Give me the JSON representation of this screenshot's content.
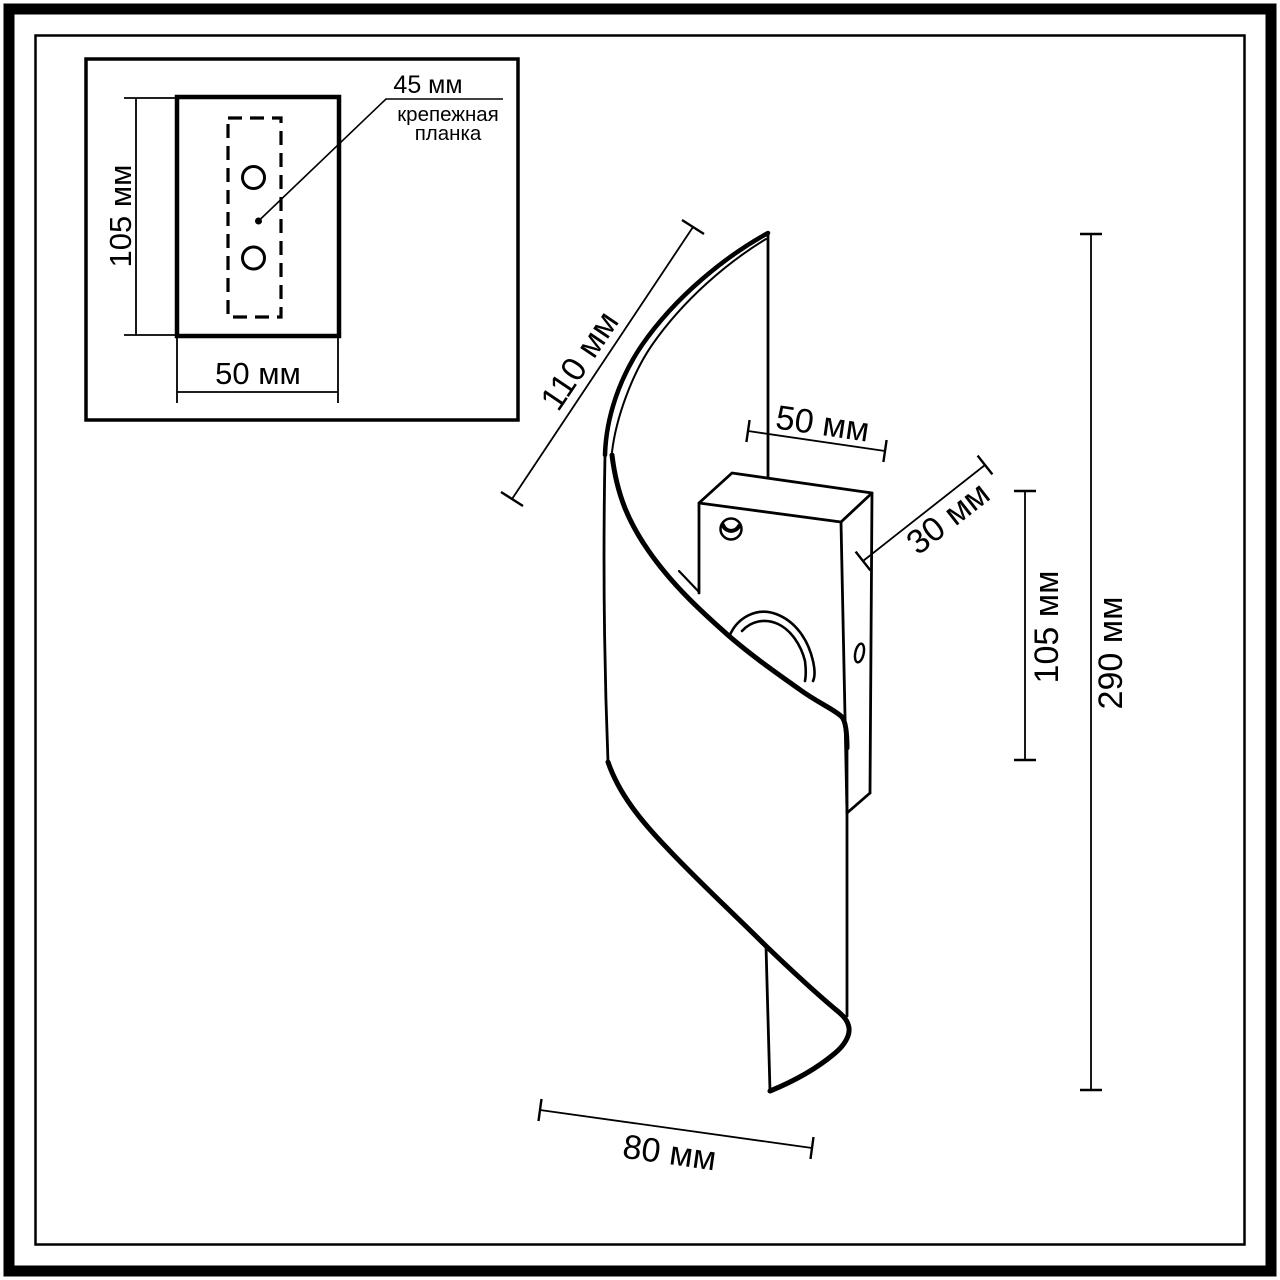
{
  "drawing": {
    "type": "dimensional line drawing",
    "subject": "spiral wall sconce with mounting plate"
  },
  "inset": {
    "plate_height": "105 мм",
    "plate_width": "50 мм",
    "hole_spacing": "45 мм",
    "callout_line1": "крепежная",
    "callout_line2": "планка"
  },
  "main_view": {
    "shade_edge_length": "110 мм",
    "backplate_width": "50 мм",
    "backplate_depth": "30 мм",
    "backplate_height": "105 мм",
    "total_height": "290 мм",
    "shade_width": "80 мм"
  },
  "colors": {
    "ink": "#000000",
    "background": "#ffffff"
  }
}
